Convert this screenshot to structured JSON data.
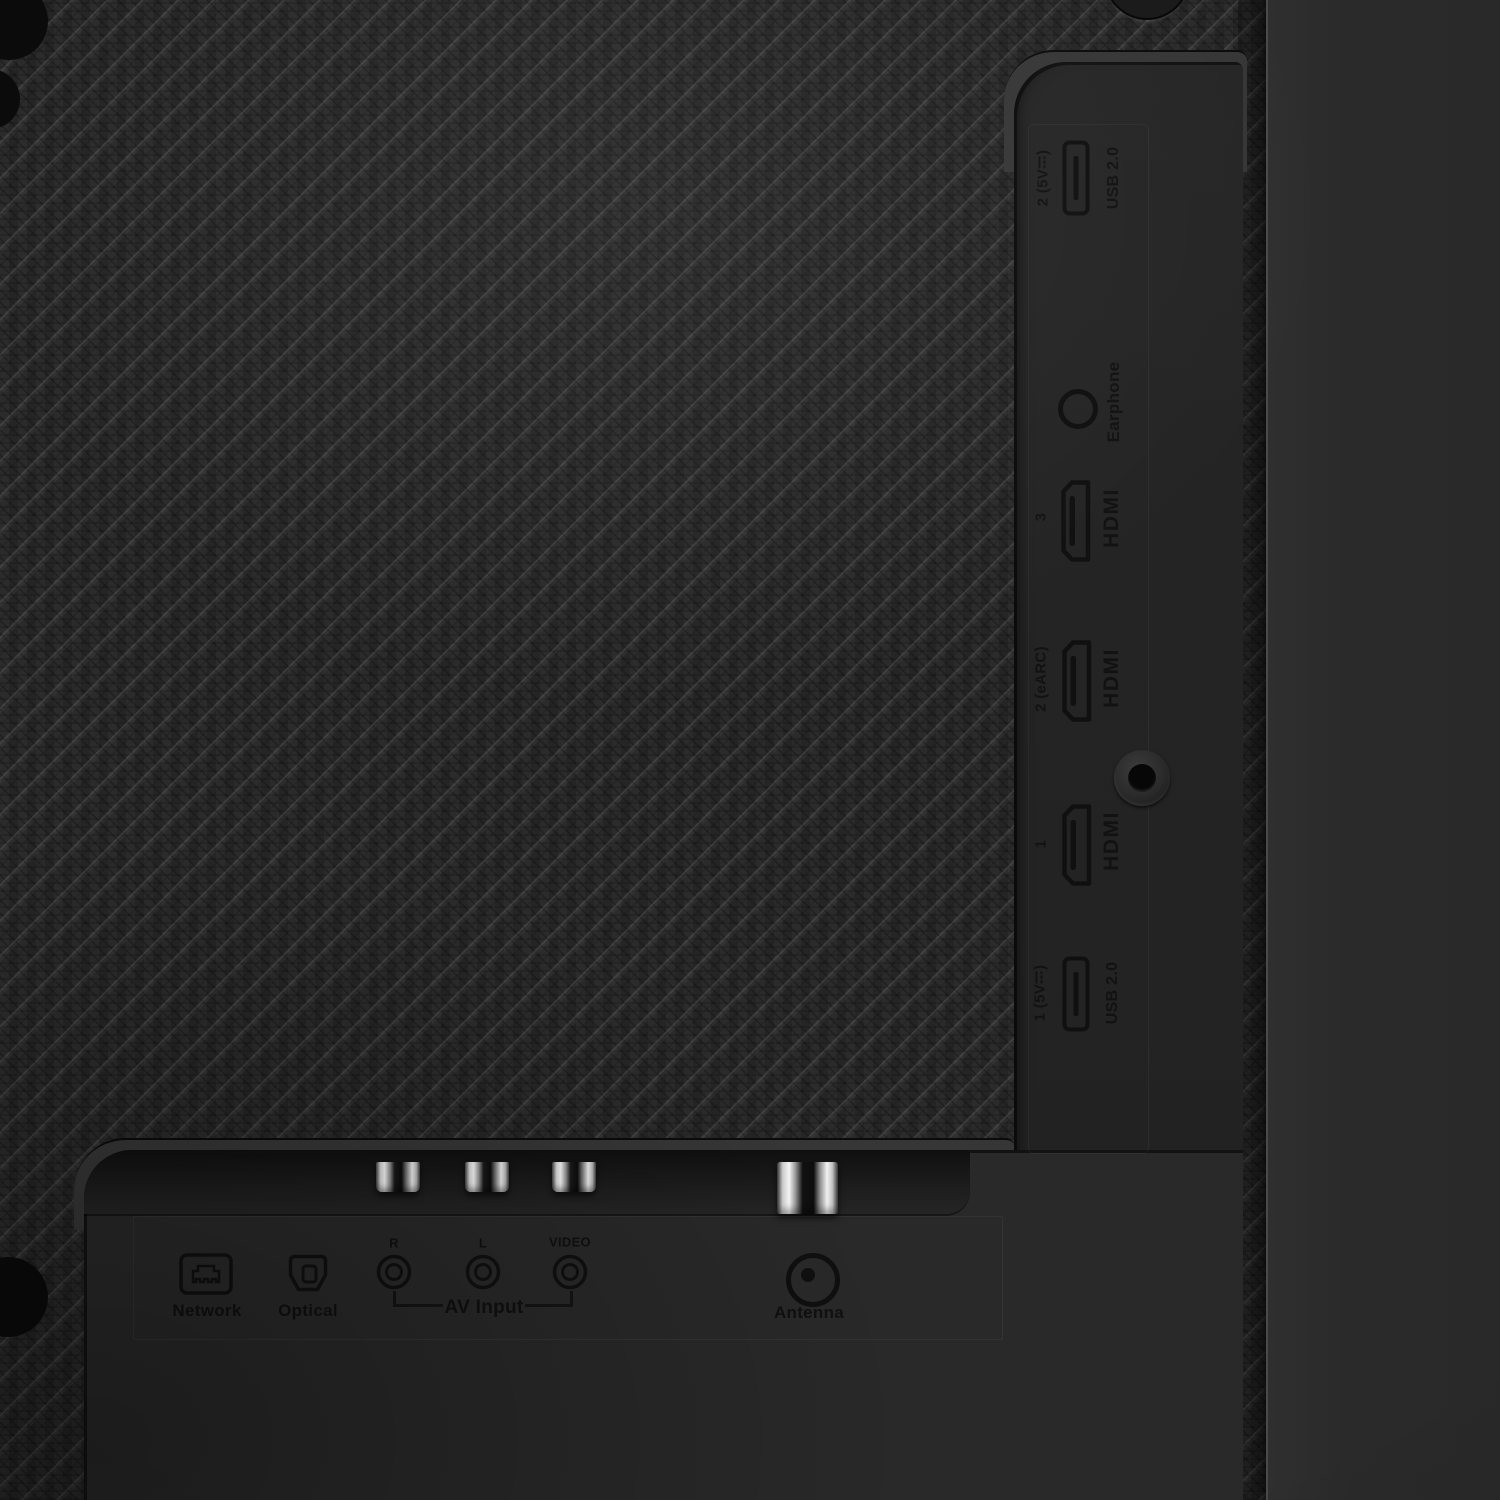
{
  "right_panel": {
    "ports": [
      {
        "name": "usb-2",
        "icon": "usb-port-icon",
        "left_label": "2 (5V⎓)",
        "right_label": "USB 2.0"
      },
      {
        "name": "earphone",
        "icon": "earphone-jack-icon",
        "left_label": "",
        "right_label": "Earphone"
      },
      {
        "name": "hdmi-3",
        "icon": "hdmi-port-icon",
        "left_label": "3",
        "right_label": "HDMI"
      },
      {
        "name": "hdmi-2",
        "icon": "hdmi-port-icon",
        "left_label": "2 (eARC)",
        "right_label": "HDMI"
      },
      {
        "name": "hdmi-1",
        "icon": "hdmi-port-icon",
        "left_label": "1",
        "right_label": "HDMI"
      },
      {
        "name": "usb-1",
        "icon": "usb-port-icon",
        "left_label": "1 (5V⎓)",
        "right_label": "USB 2.0"
      }
    ]
  },
  "bottom_panel": {
    "network_label": "Network",
    "network_icon": "ethernet-port-icon",
    "optical_label": "Optical",
    "optical_icon": "optical-port-icon",
    "av": {
      "r_label": "R",
      "l_label": "L",
      "video_label": "VIDEO",
      "group_label": "AV Input",
      "jack_icon": "rca-jack-icon"
    },
    "antenna_label": "Antenna",
    "antenna_icon": "coax-antenna-icon"
  },
  "colors": {
    "carbon_base": "#272727",
    "panel": "#242424",
    "side_column": "#2b2b2b",
    "markings": "#111111",
    "metal_highlight": "#f4f4f4"
  }
}
